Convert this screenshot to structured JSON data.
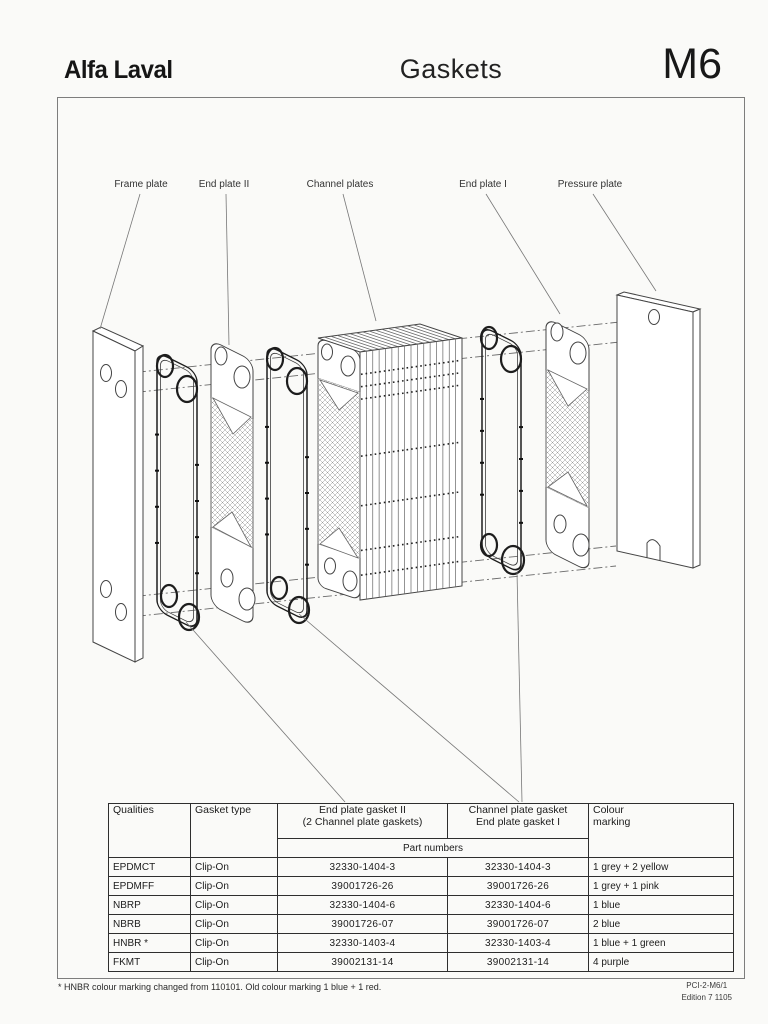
{
  "header": {
    "logo": "Alfa Laval",
    "title": "Gaskets",
    "model_code": "M6"
  },
  "diagram": {
    "labels": [
      "Frame plate",
      "End plate II",
      "Channel plates",
      "End plate I",
      "Pressure plate"
    ]
  },
  "table": {
    "col_qualities": "Qualities",
    "col_gasket_type": "Gasket type",
    "col_end_gasket_line1": "End plate gasket II",
    "col_end_gasket_line2": "(2 Channel plate gaskets)",
    "col_channel_gasket_line1": "Channel plate gasket",
    "col_channel_gasket_line2": "End plate gasket I",
    "col_colour_line1": "Colour",
    "col_colour_line2": "marking",
    "part_numbers_label": "Part numbers",
    "rows": [
      {
        "quality": "EPDMCT",
        "gasket_type": "Clip-On",
        "part_end_gasket": "32330-1404-3",
        "part_channel_gasket": "32330-1404-3",
        "colour_marking": "1 grey + 2 yellow"
      },
      {
        "quality": "EPDMFF",
        "gasket_type": "Clip-On",
        "part_end_gasket": "39001726-26",
        "part_channel_gasket": "39001726-26",
        "colour_marking": "1 grey + 1 pink"
      },
      {
        "quality": "NBRP",
        "gasket_type": "Clip-On",
        "part_end_gasket": "32330-1404-6",
        "part_channel_gasket": "32330-1404-6",
        "colour_marking": "1 blue"
      },
      {
        "quality": "NBRB",
        "gasket_type": "Clip-On",
        "part_end_gasket": "39001726-07",
        "part_channel_gasket": "39001726-07",
        "colour_marking": "2 blue"
      },
      {
        "quality": "HNBR *",
        "gasket_type": "Clip-On",
        "part_end_gasket": "32330-1403-4",
        "part_channel_gasket": "32330-1403-4",
        "colour_marking": "1 blue + 1 green"
      },
      {
        "quality": "FKMT",
        "gasket_type": "Clip-On",
        "part_end_gasket": "39002131-14",
        "part_channel_gasket": "39002131-14",
        "colour_marking": "4 purple"
      }
    ]
  },
  "footnote": "* HNBR colour marking changed from 110101. Old colour marking 1 blue + 1 red.",
  "doc_ref": {
    "code": "PCI-2-M6/1",
    "edition": "Edition 7 1105"
  }
}
